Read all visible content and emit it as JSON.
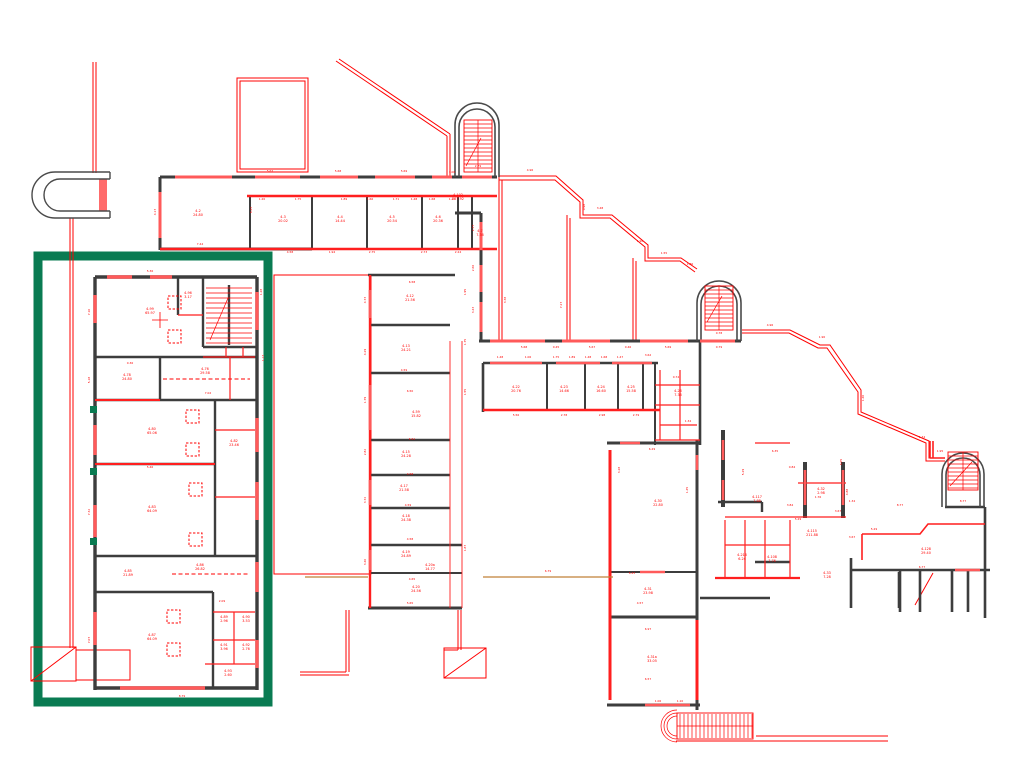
{
  "drawing": {
    "kind": "architectural-floor-plan",
    "highlight_box": {
      "x": 38,
      "y": 256,
      "w": 230,
      "h": 446,
      "color": "#0a7b52"
    },
    "colors": {
      "line_red": "#ff0000",
      "window_red": "#ff5a5a",
      "wall_gray": "#3d3d3d",
      "reference_tan": "#c08037",
      "highlight_green": "#0a7b52",
      "background": "#ffffff"
    }
  },
  "rooms": [
    {
      "id": "4-2",
      "area": "24.80",
      "x": 198,
      "y": 212
    },
    {
      "id": "4-3",
      "area": "20.02",
      "x": 283,
      "y": 218
    },
    {
      "id": "4-4",
      "area": "14.44",
      "x": 340,
      "y": 218
    },
    {
      "id": "4-5",
      "area": "20.54",
      "x": 392,
      "y": 218
    },
    {
      "id": "4-6",
      "area": "20.36",
      "x": 438,
      "y": 218
    },
    {
      "id": "4-7",
      "area": "7.36",
      "x": 480,
      "y": 232
    },
    {
      "id": "4-102",
      "area": "257.92",
      "x": 458,
      "y": 196
    },
    {
      "id": "4-96",
      "area": "3.17",
      "x": 188,
      "y": 294
    },
    {
      "id": "4-99",
      "area": "65.97",
      "x": 150,
      "y": 310
    },
    {
      "id": "4-78",
      "area": "24.80",
      "x": 127,
      "y": 376
    },
    {
      "id": "4-76",
      "area": "29.58",
      "x": 205,
      "y": 370
    },
    {
      "id": "4-80",
      "area": "65.06",
      "x": 152,
      "y": 430
    },
    {
      "id": "4-82",
      "area": "23.46",
      "x": 234,
      "y": 442
    },
    {
      "id": "4-83",
      "area": "64.09",
      "x": 152,
      "y": 508
    },
    {
      "id": "4-85",
      "area": "21.89",
      "x": 128,
      "y": 572
    },
    {
      "id": "4-86",
      "area": "26.82",
      "x": 200,
      "y": 566
    },
    {
      "id": "4-87",
      "area": "64.09",
      "x": 152,
      "y": 636
    },
    {
      "id": "4-89",
      "area": "2.96",
      "x": 224,
      "y": 618
    },
    {
      "id": "4-90",
      "area": "3.53",
      "x": 246,
      "y": 618
    },
    {
      "id": "4-91",
      "area": "3.96",
      "x": 224,
      "y": 646
    },
    {
      "id": "4-92",
      "area": "2.76",
      "x": 246,
      "y": 646
    },
    {
      "id": "4-93",
      "area": "2.60",
      "x": 228,
      "y": 672
    },
    {
      "id": "4-12",
      "area": "21.56",
      "x": 410,
      "y": 297
    },
    {
      "id": "4-13",
      "area": "24.21",
      "x": 406,
      "y": 347
    },
    {
      "id": "4-59",
      "area": "15.82",
      "x": 416,
      "y": 413
    },
    {
      "id": "4-15",
      "area": "24.28",
      "x": 406,
      "y": 453
    },
    {
      "id": "4-17",
      "area": "21.58",
      "x": 404,
      "y": 487
    },
    {
      "id": "4-18",
      "area": "24.38",
      "x": 406,
      "y": 517
    },
    {
      "id": "4-19",
      "area": "24.89",
      "x": 406,
      "y": 553
    },
    {
      "id": "4-20a",
      "area": "14.77",
      "x": 430,
      "y": 566
    },
    {
      "id": "4-20",
      "area": "24.56",
      "x": 416,
      "y": 588
    },
    {
      "id": "4-22",
      "area": "20.76",
      "x": 516,
      "y": 388
    },
    {
      "id": "4-23",
      "area": "14.66",
      "x": 564,
      "y": 388
    },
    {
      "id": "4-24",
      "area": "16.60",
      "x": 601,
      "y": 388
    },
    {
      "id": "4-25",
      "area": "15.58",
      "x": 631,
      "y": 388
    },
    {
      "id": "4-26",
      "area": "7.36",
      "x": 678,
      "y": 392
    },
    {
      "id": "4-30",
      "area": "22.80",
      "x": 658,
      "y": 502
    },
    {
      "id": "4-31",
      "area": "23.98",
      "x": 648,
      "y": 590
    },
    {
      "id": "4-31a",
      "area": "33.05",
      "x": 652,
      "y": 658
    },
    {
      "id": "4-117",
      "area": "7.88",
      "x": 757,
      "y": 498
    },
    {
      "id": "4-115",
      "area": "211.88",
      "x": 812,
      "y": 532
    },
    {
      "id": "4-32",
      "area": "2.98",
      "x": 821,
      "y": 490
    },
    {
      "id": "4-33",
      "area": "7.28",
      "x": 827,
      "y": 574
    },
    {
      "id": "4-216",
      "area": "6.24",
      "x": 742,
      "y": 556
    },
    {
      "id": "4-108",
      "area": "7.76",
      "x": 772,
      "y": 558
    },
    {
      "id": "4-128",
      "area": "29.40",
      "x": 926,
      "y": 550
    }
  ],
  "dims": [
    {
      "t": "5.67",
      "x": 270,
      "y": 172
    },
    {
      "t": "5.68",
      "x": 338,
      "y": 172
    },
    {
      "t": "5.69",
      "x": 404,
      "y": 172
    },
    {
      "t": "1.06",
      "x": 452,
      "y": 173
    },
    {
      "t": "2.79",
      "x": 478,
      "y": 167
    },
    {
      "t": "4.17",
      "x": 156,
      "y": 212,
      "v": 1
    },
    {
      "t": "6.43",
      "x": 252,
      "y": 210,
      "v": 1
    },
    {
      "t": "7.44",
      "x": 200,
      "y": 245
    },
    {
      "t": "4.58",
      "x": 290,
      "y": 253
    },
    {
      "t": "1.94",
      "x": 332,
      "y": 253
    },
    {
      "t": "2.75",
      "x": 372,
      "y": 253
    },
    {
      "t": "2.73",
      "x": 424,
      "y": 253
    },
    {
      "t": "2.24",
      "x": 458,
      "y": 253
    },
    {
      "t": "1.20",
      "x": 262,
      "y": 200
    },
    {
      "t": "1.75",
      "x": 298,
      "y": 200
    },
    {
      "t": "1.89",
      "x": 344,
      "y": 200
    },
    {
      "t": "1.66",
      "x": 370,
      "y": 200
    },
    {
      "t": "1.71",
      "x": 396,
      "y": 200
    },
    {
      "t": "1.48",
      "x": 414,
      "y": 200
    },
    {
      "t": "1.68",
      "x": 432,
      "y": 200
    },
    {
      "t": "1.47",
      "x": 452,
      "y": 200
    },
    {
      "t": "4.96",
      "x": 530,
      "y": 171
    },
    {
      "t": "3.48",
      "x": 600,
      "y": 209
    },
    {
      "t": "1.90",
      "x": 640,
      "y": 242
    },
    {
      "t": "1.55",
      "x": 664,
      "y": 254
    },
    {
      "t": "1.86",
      "x": 690,
      "y": 265
    },
    {
      "t": "0.98",
      "x": 585,
      "y": 207,
      "v": 1
    },
    {
      "t": "2.77",
      "x": 474,
      "y": 228,
      "v": 1
    },
    {
      "t": "2.66",
      "x": 474,
      "y": 268,
      "v": 1
    },
    {
      "t": "3.43",
      "x": 474,
      "y": 310,
      "v": 1
    },
    {
      "t": "3.38",
      "x": 506,
      "y": 300,
      "v": 1
    },
    {
      "t": "7.27",
      "x": 562,
      "y": 305,
      "v": 1
    },
    {
      "t": "5.68",
      "x": 524,
      "y": 348
    },
    {
      "t": "0.45",
      "x": 556,
      "y": 348
    },
    {
      "t": "5.67",
      "x": 592,
      "y": 348
    },
    {
      "t": "0.46",
      "x": 628,
      "y": 348
    },
    {
      "t": "5.69",
      "x": 668,
      "y": 348
    },
    {
      "t": "0.78",
      "x": 719,
      "y": 334
    },
    {
      "t": "0.79",
      "x": 719,
      "y": 348
    },
    {
      "t": "8.77",
      "x": 963,
      "y": 502
    },
    {
      "t": "6.58",
      "x": 412,
      "y": 283
    },
    {
      "t": "4.59",
      "x": 404,
      "y": 371
    },
    {
      "t": "6.50",
      "x": 410,
      "y": 392
    },
    {
      "t": "6.51",
      "x": 412,
      "y": 440
    },
    {
      "t": "4.58",
      "x": 410,
      "y": 475
    },
    {
      "t": "4.59",
      "x": 408,
      "y": 506
    },
    {
      "t": "4.58",
      "x": 410,
      "y": 540
    },
    {
      "t": "4.65",
      "x": 412,
      "y": 580
    },
    {
      "t": "5.65",
      "x": 410,
      "y": 604
    },
    {
      "t": "4.73",
      "x": 366,
      "y": 300,
      "v": 1
    },
    {
      "t": "4.29",
      "x": 366,
      "y": 352,
      "v": 1
    },
    {
      "t": "1.79",
      "x": 366,
      "y": 400,
      "v": 1
    },
    {
      "t": "2.82",
      "x": 366,
      "y": 452,
      "v": 1
    },
    {
      "t": "3.72",
      "x": 366,
      "y": 500,
      "v": 1
    },
    {
      "t": "3.40",
      "x": 366,
      "y": 562,
      "v": 1
    },
    {
      "t": "1.95",
      "x": 466,
      "y": 292,
      "v": 1
    },
    {
      "t": "1.75",
      "x": 466,
      "y": 342,
      "v": 1
    },
    {
      "t": "1.55",
      "x": 466,
      "y": 392,
      "v": 1
    },
    {
      "t": "1.87",
      "x": 466,
      "y": 548,
      "v": 1
    },
    {
      "t": "1.48",
      "x": 500,
      "y": 358
    },
    {
      "t": "1.06",
      "x": 528,
      "y": 358
    },
    {
      "t": "1.75",
      "x": 556,
      "y": 358
    },
    {
      "t": "1.89",
      "x": 572,
      "y": 358
    },
    {
      "t": "1.48",
      "x": 588,
      "y": 358
    },
    {
      "t": "1.68",
      "x": 604,
      "y": 358
    },
    {
      "t": "1.47",
      "x": 620,
      "y": 358
    },
    {
      "t": "3.62",
      "x": 648,
      "y": 356
    },
    {
      "t": "5.56",
      "x": 516,
      "y": 416
    },
    {
      "t": "2.78",
      "x": 564,
      "y": 416
    },
    {
      "t": "2.98",
      "x": 602,
      "y": 416
    },
    {
      "t": "2.79",
      "x": 636,
      "y": 416
    },
    {
      "t": "0.74",
      "x": 676,
      "y": 378
    },
    {
      "t": "1.34",
      "x": 688,
      "y": 422
    },
    {
      "t": "6.29",
      "x": 652,
      "y": 450
    },
    {
      "t": "3.28",
      "x": 620,
      "y": 470,
      "v": 1
    },
    {
      "t": "1.45",
      "x": 688,
      "y": 490,
      "v": 1
    },
    {
      "t": "6.43",
      "x": 632,
      "y": 574
    },
    {
      "t": "4.57",
      "x": 640,
      "y": 604
    },
    {
      "t": "6.97",
      "x": 648,
      "y": 630
    },
    {
      "t": "6.57",
      "x": 648,
      "y": 680
    },
    {
      "t": "1.06",
      "x": 658,
      "y": 702
    },
    {
      "t": "1.10",
      "x": 680,
      "y": 702
    },
    {
      "t": "6.79",
      "x": 548,
      "y": 572
    },
    {
      "t": "6.35",
      "x": 775,
      "y": 452
    },
    {
      "t": "0.84",
      "x": 792,
      "y": 468
    },
    {
      "t": "5.29",
      "x": 744,
      "y": 472,
      "v": 1
    },
    {
      "t": "3.84",
      "x": 790,
      "y": 506
    },
    {
      "t": "5.29",
      "x": 798,
      "y": 520
    },
    {
      "t": "3.67",
      "x": 838,
      "y": 512
    },
    {
      "t": "1.76",
      "x": 818,
      "y": 498
    },
    {
      "t": "1.34",
      "x": 852,
      "y": 502
    },
    {
      "t": "8.77",
      "x": 900,
      "y": 506
    },
    {
      "t": "3.67",
      "x": 852,
      "y": 538
    },
    {
      "t": "5.29",
      "x": 874,
      "y": 530
    },
    {
      "t": "6.77",
      "x": 922,
      "y": 568
    },
    {
      "t": "6.05",
      "x": 842,
      "y": 462,
      "v": 1
    },
    {
      "t": "4.88",
      "x": 848,
      "y": 492,
      "v": 1
    },
    {
      "t": "1.40",
      "x": 864,
      "y": 398,
      "v": 1
    },
    {
      "t": "1.90",
      "x": 822,
      "y": 338
    },
    {
      "t": "4.96",
      "x": 770,
      "y": 326
    },
    {
      "t": "1.34",
      "x": 922,
      "y": 438
    },
    {
      "t": "1.95",
      "x": 940,
      "y": 452
    },
    {
      "t": "5.36",
      "x": 150,
      "y": 272
    },
    {
      "t": "7.10",
      "x": 90,
      "y": 312,
      "v": 1
    },
    {
      "t": "5.18",
      "x": 90,
      "y": 380,
      "v": 1
    },
    {
      "t": "7.32",
      "x": 90,
      "y": 512,
      "v": 1
    },
    {
      "t": "7.07",
      "x": 90,
      "y": 640,
      "v": 1
    },
    {
      "t": "8.79",
      "x": 182,
      "y": 697
    },
    {
      "t": "1.28",
      "x": 262,
      "y": 292,
      "v": 1
    },
    {
      "t": "1.13",
      "x": 264,
      "y": 358,
      "v": 1
    },
    {
      "t": "5.46",
      "x": 150,
      "y": 468
    },
    {
      "t": "7.02",
      "x": 208,
      "y": 394
    },
    {
      "t": "0.36",
      "x": 130,
      "y": 364
    },
    {
      "t": "2.09",
      "x": 222,
      "y": 602
    }
  ]
}
